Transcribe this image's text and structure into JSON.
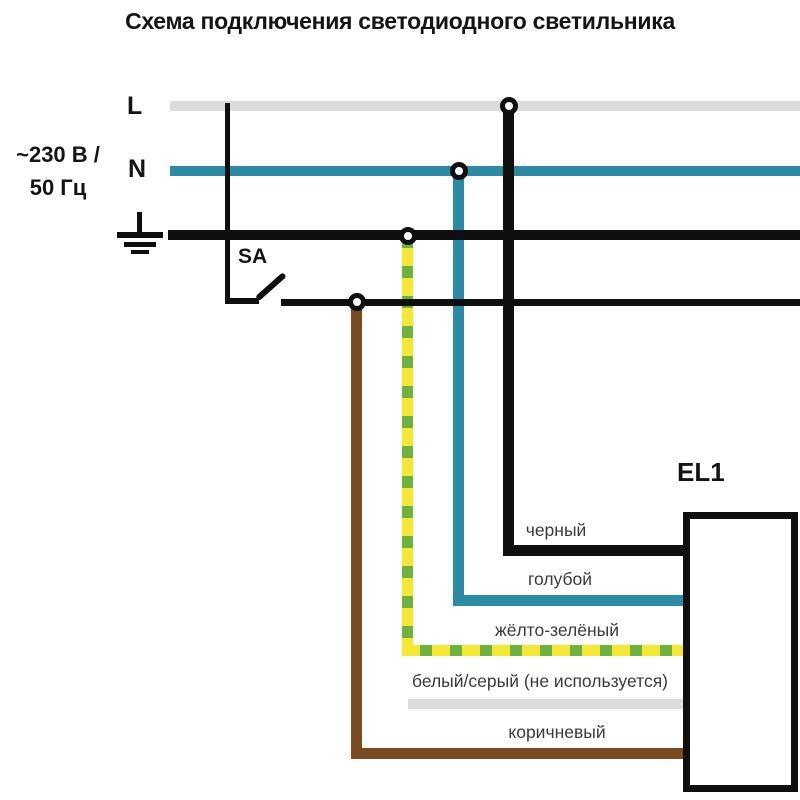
{
  "title": "Схема подключения светодиодного светильника",
  "supply": {
    "voltage": "~230 В /",
    "frequency": "50 Гц",
    "phase_label": "L",
    "neutral_label": "N"
  },
  "switch": {
    "label": "SA"
  },
  "luminaire": {
    "label": "EL1"
  },
  "wires": {
    "black": {
      "label": "черный"
    },
    "blue": {
      "label": "голубой"
    },
    "yellow_green": {
      "label": "жёлто-зелёный"
    },
    "white_gray": {
      "label": "белый/серый (не используется)"
    },
    "brown": {
      "label": "коричневый"
    }
  },
  "colors": {
    "line-black": "#0f0f0f",
    "line-gray": "#dcdcdc",
    "line-teal": "#2b8ba4",
    "wire-brown": "#7a4a21",
    "wire-yellow": "#f5e832",
    "wire-green": "#6cb23c",
    "label-text": "#3a3a3a",
    "title-text": "#141414"
  }
}
